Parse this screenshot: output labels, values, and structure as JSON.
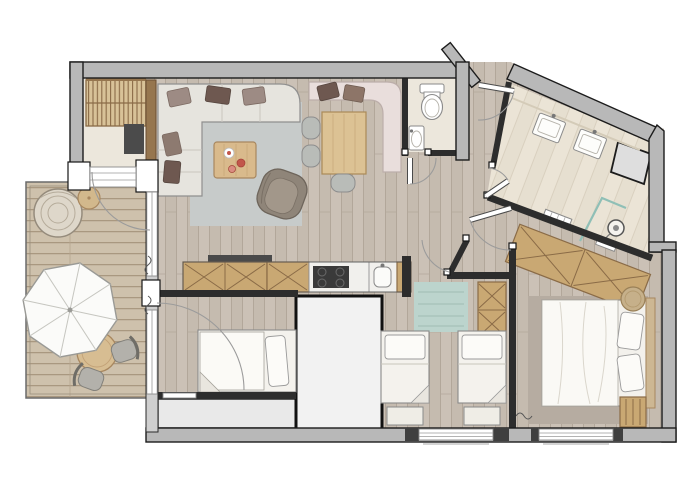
{
  "title": "Apartment floor plan",
  "image_type": "architectural-floor-plan",
  "palette": {
    "wall_exterior": "#b8b8b8",
    "wall_interior": "#2d2d2d",
    "outline": "#1c1c1c",
    "floor_wood": "#cbc1b6",
    "floor_wood_line": "#b2a79a",
    "floor_bath": "#ebe4d6",
    "floor_cream": "#ece7dc",
    "deck": "#cec1ac",
    "deck_line": "#a99880",
    "rug_gray": "#c7cbca",
    "rug_teal": "#bcd4cd",
    "rug_taupe": "#b6aca1",
    "wood_furniture": "#c9a873",
    "wood_frame": "#8a6b47",
    "wood_table": "#dcc294",
    "white_furniture": "#f5f3ee",
    "sofa": "#e6e4de",
    "bench_pink": "#e9dedc",
    "pillow_mauve": "#9d8b84",
    "pillow_brown": "#6e5850",
    "chair_gray": "#b9bcb8",
    "glass_teal": "#8fbfb6",
    "tv_dark": "#4b4b4b",
    "cooktop": "#3a3a3a",
    "balcony": "#e9e9e9",
    "shaft": "#f2f2f2",
    "armchair": "#8f8579",
    "umbrella": "#fbfbf9"
  },
  "rooms": [
    {
      "id": "living-room",
      "furniture": [
        "corner-sofa",
        "sofa-cushions",
        "coffee-table",
        "armchair",
        "rug",
        "tv",
        "slatted-wall-unit"
      ]
    },
    {
      "id": "dining-area",
      "furniture": [
        "corner-bench",
        "bench-cushions",
        "dining-table",
        "three-chairs"
      ]
    },
    {
      "id": "kitchen",
      "furniture": [
        "sideboard",
        "cooktop",
        "sink",
        "tv-bar"
      ]
    },
    {
      "id": "wc",
      "furniture": [
        "toilet",
        "washbasin"
      ]
    },
    {
      "id": "hallway",
      "furniture": [
        "entry-door"
      ]
    },
    {
      "id": "bathroom",
      "furniture": [
        "washbasin",
        "washbasin",
        "shower",
        "glass-screen",
        "towel-radiator"
      ]
    },
    {
      "id": "storage-closet",
      "furniture": []
    },
    {
      "id": "bedroom",
      "furniture": [
        "double-bed",
        "two-pillows",
        "wardrobe",
        "stool",
        "rug",
        "corner-cabinet"
      ]
    },
    {
      "id": "kids-bedroom",
      "furniture": [
        "single-bed",
        "single-bed",
        "wardrobe",
        "rug"
      ]
    },
    {
      "id": "sleeping-niche",
      "furniture": [
        "single-bed"
      ]
    },
    {
      "id": "terrace",
      "furniture": [
        "parasol",
        "round-table",
        "two-chairs",
        "hanging-chair",
        "side-table",
        "wood-deck"
      ]
    },
    {
      "id": "balcony",
      "furniture": []
    },
    {
      "id": "shaft",
      "furniture": []
    }
  ]
}
